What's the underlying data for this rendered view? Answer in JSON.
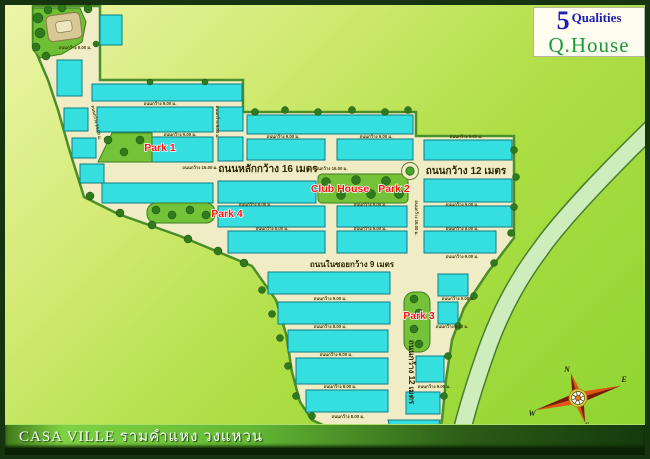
{
  "title_bar": {
    "text": "CASA VILLE รามคำแหง วงแหวน"
  },
  "logo": {
    "number": "5",
    "qualities": "Qualities",
    "brand": "Q.House"
  },
  "road_labels": {
    "main_16m": "ถนนหลักกว้าง 16 เมตร",
    "east_12m": "ถนนกว้าง 12 เมตร",
    "soi_9m": "ถนนในซอยกว้าง 9 เมตร",
    "south_12m": "ถนนกว้าง 12 เมตร",
    "w8": "ถนนกว้าง 8.00 ม.",
    "w9": "ถนนกว้าง 9.00 ม.",
    "w14": "ถนนกว้าง 14.00 ม.",
    "w16": "ถนนกว้าง 16.00 ม."
  },
  "place_labels": {
    "park1": "Park 1",
    "park2": "Park 2",
    "park3": "Park 3",
    "park4": "Park 4",
    "club_house": "Club House"
  },
  "compass": {
    "n": "N",
    "e": "E",
    "w": "W",
    "s": "S"
  },
  "colors": {
    "lot_cyan": "#35dfe0",
    "land_beige": "#f0ecc6",
    "label_red": "#ff1010",
    "logo_blue": "#2020b0",
    "logo_green": "#169a3a",
    "title_band_green": "#63b934",
    "bg_light": "#eef5ac",
    "bg_dark": "#8bd430"
  }
}
